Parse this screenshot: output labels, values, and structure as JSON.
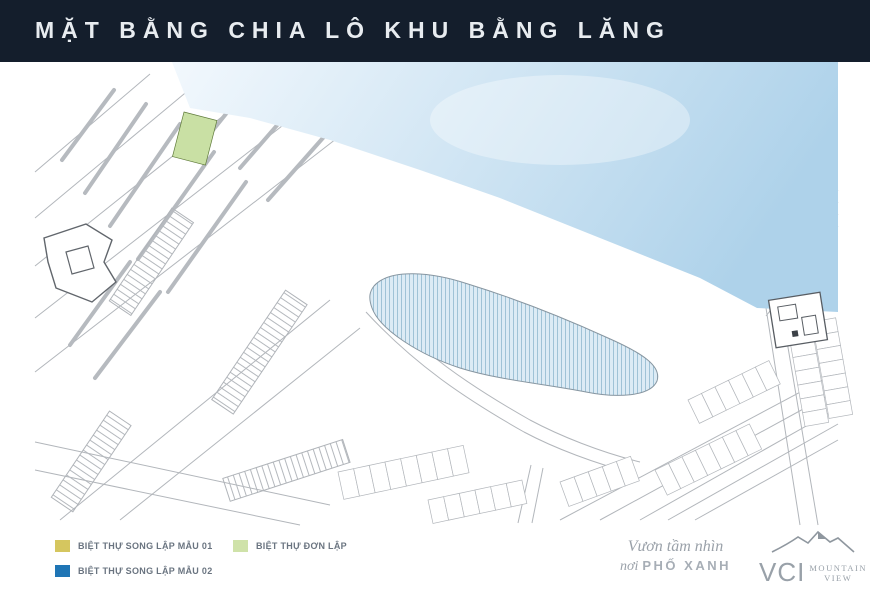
{
  "header": {
    "title": "MẶT BẰNG CHIA LÔ KHU BẰNG LĂNG"
  },
  "map": {
    "compass_label": "Bắc",
    "road_labels": [
      "ĐI KHU DÂN CƯ",
      "ĐI KHU DÂN CƯ"
    ],
    "colors": {
      "teal_lot": "#7ec5c9",
      "yellow_lot": "#cdd88b",
      "green_lot": "#c9e0a4",
      "blue_lot": "#2a72b5",
      "marker": "#e0453a",
      "sky_light": "#f2f8fd",
      "sky_deep": "#aed2ea",
      "water": "#dcebf5"
    },
    "blocks": {
      "bl1": {
        "label": "BL1",
        "start_green_area": "347m²",
        "teal_area": "190m²",
        "teal_count_left": 4,
        "teal_count_main": 31,
        "end_green_area": "352m²"
      },
      "bl2": {
        "label": "BL2",
        "first_area": "372.7m²",
        "mid_area": "300m²",
        "mid_count": 15,
        "last_area": "414.5m²"
      },
      "bl3": {
        "label": "BL3",
        "left_areas": [
          "327m²",
          "318m²",
          "318m²",
          "310m²",
          "316m²",
          "227m²"
        ],
        "right_areas": [
          "222.5m²",
          "218m²",
          "218m²",
          "218m²",
          "192.5m²"
        ]
      }
    }
  },
  "legend": {
    "items": [
      {
        "label": "BIỆT THỰ SONG LẬP MẪU 01",
        "color": "#d5c65f"
      },
      {
        "label": "BIỆT THỰ SONG LẬP MẪU 02",
        "color": "#1f75b5"
      },
      {
        "label": "BIỆT THỰ ĐƠN LẬP",
        "color": "#cfe2a9"
      }
    ]
  },
  "footer": {
    "slogan_line1": "Vươn tầm nhìn",
    "slogan_word": "nơi",
    "slogan_brand": "PHỐ XANH",
    "logo_name": "VCI",
    "logo_sub1": "MOUNTAIN",
    "logo_sub2": "VIEW"
  }
}
